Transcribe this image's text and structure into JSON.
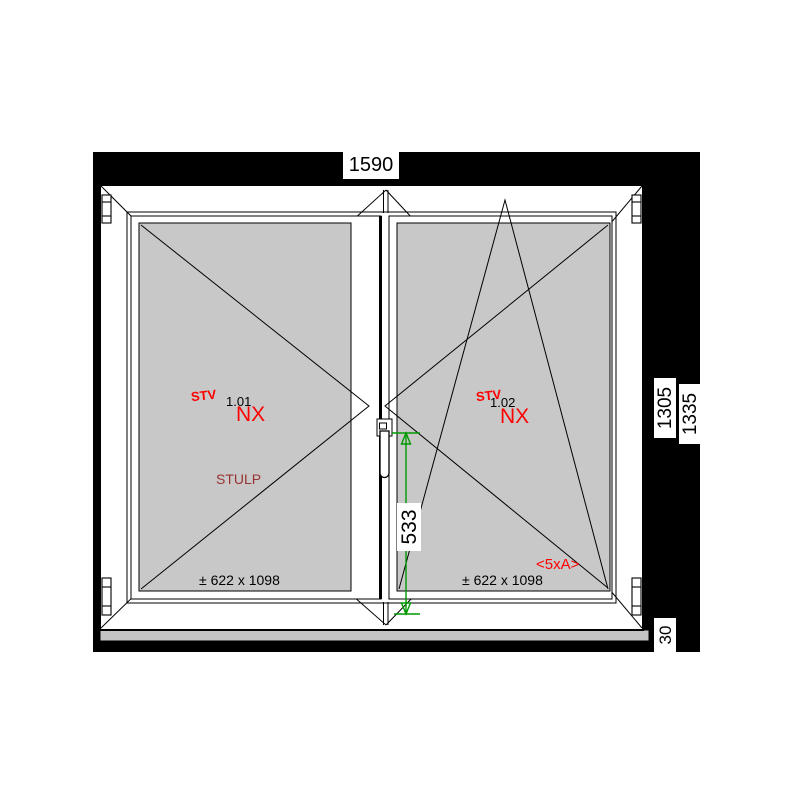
{
  "drawing_type": "window-technical-drawing",
  "dimensions": {
    "width": "1590",
    "height_frame": "1305",
    "height_total": "1335",
    "sill_height": "30",
    "handle_height": "533"
  },
  "pane_left": {
    "stv": "STV",
    "position_id": "1.01",
    "code": "NX",
    "note": "STULP",
    "glass_size": "± 622 x 1098"
  },
  "pane_right": {
    "stv": "STV",
    "position_id": "1.02",
    "code": "NX",
    "note": "<5xA>",
    "glass_size": "± 622 x 1098"
  },
  "colors": {
    "wall": "#000000",
    "glass": "#c8c8c8",
    "sill": "#c4c4c4",
    "frame": "#ffffff",
    "outline": "#000000",
    "label_red": "#ff0000",
    "note_dark_red": "#993333",
    "dimension_green": "#009900"
  },
  "icons": {
    "handle": "window-handle-icon",
    "hinge": "hinge-marker-icon",
    "arrow": "measure-arrow-icon"
  }
}
